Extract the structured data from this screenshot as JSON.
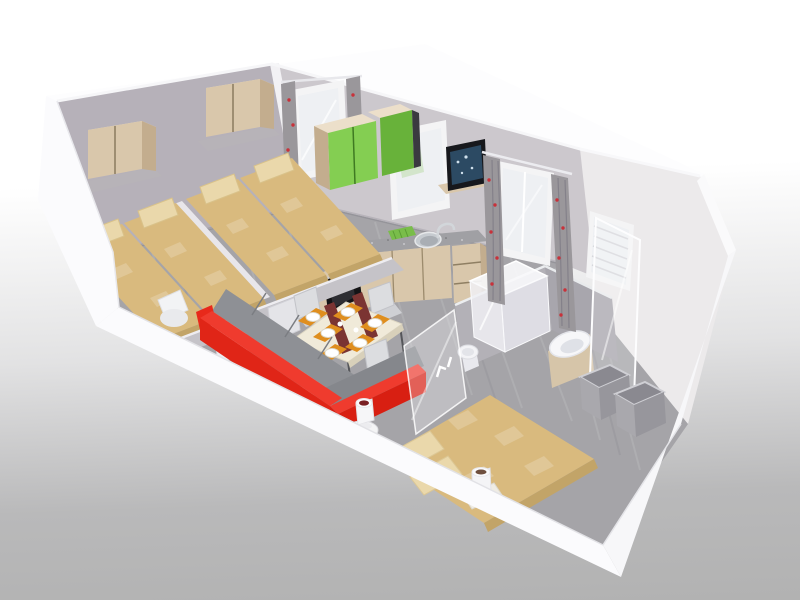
{
  "scene": {
    "title": "3D cutaway floor plan render of a mobile home",
    "style": "isometric cutaway view from above, no visible text",
    "background_top": "#ffffff",
    "background_bottom": "#b2b2b2"
  },
  "palette": {
    "bg_top": "#ffffff",
    "bg_bottom": "#b2b2b2",
    "cut_wall": "#fbfbfd",
    "wall_bedroom": "#b6b1b9",
    "wall_kitchen": "#ccc8cd",
    "wall_end": "#eceaeb",
    "floor": "#a5a4a8",
    "bed_cover": "#d9ba7e",
    "bed_cover_dark": "#c2a468",
    "pillow": "#ead8ab",
    "wood": "#d9c7ab",
    "wood_dark": "#c3ad8e",
    "wood_top": "#ecdfca",
    "shelf_gray": "#b7b3b8",
    "cabinet_green": "#84ce52",
    "cabinet_green_dark": "#68b23a",
    "curtain": "#9a979b",
    "curtain_dot": "#c8313a",
    "window_frame": "#f4f4f5",
    "glass": "#eef0f3",
    "counter": "#a0a0a4",
    "hob": "#1b1b1e",
    "oven": "#141416",
    "sink": "#c6cbd0",
    "dishrack": "#79bd4a",
    "tv_frame": "#17181c",
    "tv_screen": "#2c4a63",
    "table_top": "#f0ead9",
    "placemat": "#df8e1e",
    "runner": "#7b3432",
    "plate": "#ffffff",
    "chair": "#dcdde0",
    "chair_seat": "#cfd0d4",
    "sofa": "#e02517",
    "sofa_top": "#ef3b2e",
    "sofa_dark": "#d81f12",
    "cushion": "#8e9095",
    "armchair": "#f2f3f5",
    "partition": "#c5c3c8",
    "bath_wall": "#b3b1b7",
    "bath_wall_dark": "#a8a6ad",
    "shower": "#f4f4f6",
    "vanity": "#d6c5a9",
    "basin": "#f7f7f9",
    "cube": "#a9a8ad",
    "cube_side": "#97969c",
    "cube_inner": "#8a8990",
    "side_table": "#f4f4f5",
    "cup": "#f4f4f6",
    "drink": "#6e4f3e"
  },
  "rooms": [
    {
      "name": "twin-bedroom-1",
      "items": [
        "single bed",
        "single bed",
        "overhead wood cabinet on shelf",
        "privacy partition with doors",
        "white armchair"
      ]
    },
    {
      "name": "twin-bedroom-2",
      "items": [
        "single bed",
        "single bed",
        "overhead wood cabinet on shelf",
        "window with red-dotted curtains"
      ]
    },
    {
      "name": "kitchen",
      "items": [
        "green wall cabinets",
        "window",
        "four-burner gas hob",
        "oven",
        "stainless sink with faucet",
        "green dish drainer",
        "speckled countertop",
        "wood base cabinets",
        "open shelf unit",
        "corner shelf with flat-screen TV"
      ]
    },
    {
      "name": "living-dining",
      "items": [
        "dining table set for six",
        "white plates",
        "orange placemats",
        "maroon runners",
        "gray dining chairs",
        "red corner sofa with gray cushions",
        "white side table with drinking glass",
        "etched glass partition",
        "french door with red-dotted curtains"
      ]
    },
    {
      "name": "double-bedroom",
      "items": [
        "double bed with tan cover",
        "two pillows",
        "white cup on bedside shelf",
        "open storage cubes"
      ]
    },
    {
      "name": "bathroom",
      "items": [
        "shower cubicle",
        "tall glass shower screen",
        "washbasin on wooden vanity",
        "toilet",
        "window with blinds"
      ]
    }
  ]
}
